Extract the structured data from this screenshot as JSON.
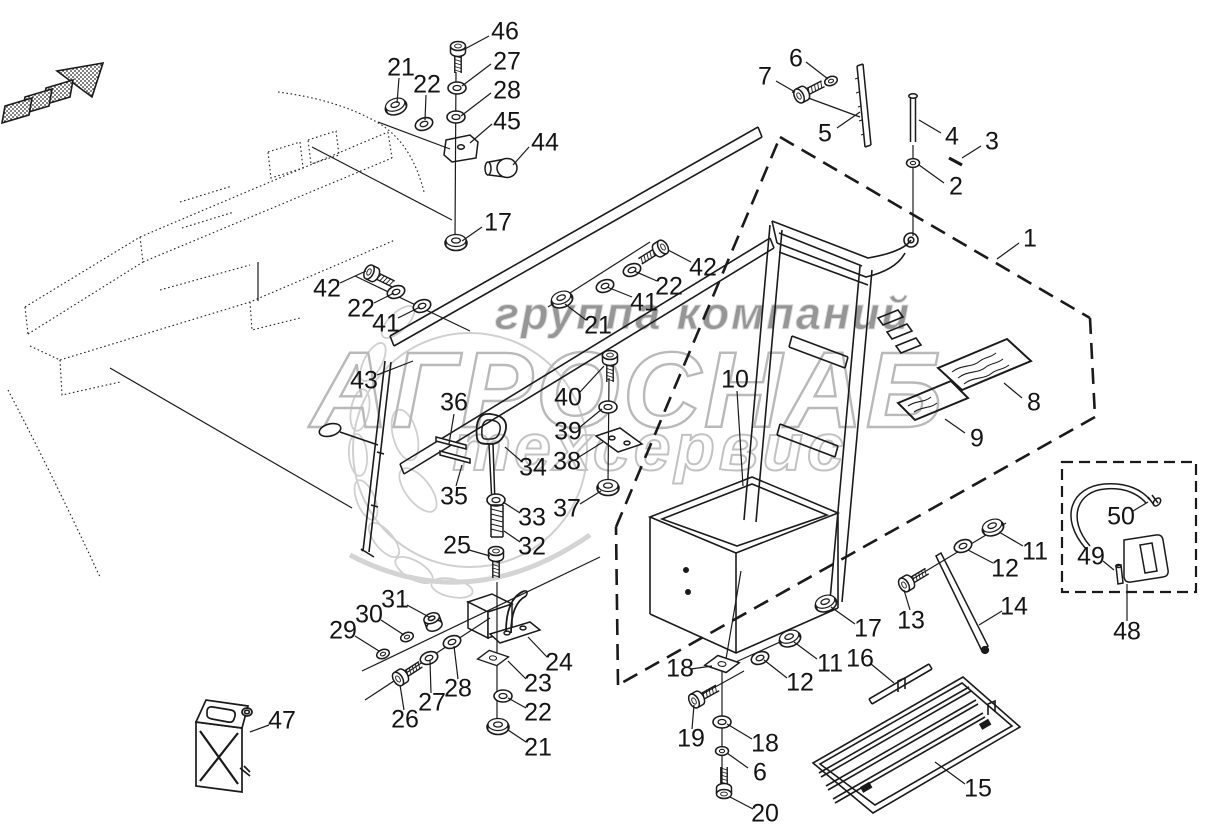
{
  "page": {
    "background": "#ffffff",
    "ink_color": "#1a1a1a",
    "type": "exploded-parts-diagram"
  },
  "watermark": {
    "line1": "группа компаний",
    "line2": "АГРОСНАБ",
    "line3": "техсервис",
    "color_dark": "#969696",
    "color_light": "#bdbdbd"
  },
  "icons": [
    {
      "name": "direction-arrow-icon",
      "meaning": "mounting direction indicator"
    }
  ],
  "diagram": {
    "labels": [
      {
        "part": "46",
        "x": 505,
        "y": 32
      },
      {
        "part": "27",
        "x": 507,
        "y": 62
      },
      {
        "part": "28",
        "x": 507,
        "y": 91
      },
      {
        "part": "45",
        "x": 507,
        "y": 122
      },
      {
        "part": "44",
        "x": 545,
        "y": 143
      },
      {
        "part": "21",
        "x": 401,
        "y": 68
      },
      {
        "part": "22",
        "x": 427,
        "y": 85
      },
      {
        "part": "17",
        "x": 498,
        "y": 223
      },
      {
        "part": "6",
        "x": 796,
        "y": 59
      },
      {
        "part": "7",
        "x": 765,
        "y": 77
      },
      {
        "part": "5",
        "x": 825,
        "y": 134
      },
      {
        "part": "4",
        "x": 952,
        "y": 137
      },
      {
        "part": "3",
        "x": 992,
        "y": 142
      },
      {
        "part": "2",
        "x": 956,
        "y": 187
      },
      {
        "part": "1",
        "x": 1030,
        "y": 239
      },
      {
        "part": "42",
        "x": 327,
        "y": 289
      },
      {
        "part": "22",
        "x": 361,
        "y": 309
      },
      {
        "part": "41",
        "x": 386,
        "y": 324
      },
      {
        "part": "43",
        "x": 364,
        "y": 381
      },
      {
        "part": "42",
        "x": 703,
        "y": 268
      },
      {
        "part": "22",
        "x": 669,
        "y": 287
      },
      {
        "part": "41",
        "x": 644,
        "y": 303
      },
      {
        "part": "21",
        "x": 598,
        "y": 326
      },
      {
        "part": "36",
        "x": 454,
        "y": 403
      },
      {
        "part": "40",
        "x": 568,
        "y": 398
      },
      {
        "part": "39",
        "x": 568,
        "y": 432
      },
      {
        "part": "38",
        "x": 567,
        "y": 462
      },
      {
        "part": "34",
        "x": 533,
        "y": 468
      },
      {
        "part": "35",
        "x": 454,
        "y": 497
      },
      {
        "part": "33",
        "x": 532,
        "y": 518
      },
      {
        "part": "37",
        "x": 567,
        "y": 509
      },
      {
        "part": "32",
        "x": 532,
        "y": 547
      },
      {
        "part": "25",
        "x": 457,
        "y": 546
      },
      {
        "part": "10",
        "x": 735,
        "y": 380
      },
      {
        "part": "8",
        "x": 1034,
        "y": 403
      },
      {
        "part": "9",
        "x": 977,
        "y": 439
      },
      {
        "part": "50",
        "x": 1121,
        "y": 517
      },
      {
        "part": "49",
        "x": 1091,
        "y": 557
      },
      {
        "part": "48",
        "x": 1127,
        "y": 632
      },
      {
        "part": "11",
        "x": 1035,
        "y": 552
      },
      {
        "part": "12",
        "x": 1005,
        "y": 569
      },
      {
        "part": "13",
        "x": 911,
        "y": 621
      },
      {
        "part": "14",
        "x": 1014,
        "y": 607
      },
      {
        "part": "31",
        "x": 395,
        "y": 600
      },
      {
        "part": "30",
        "x": 369,
        "y": 615
      },
      {
        "part": "29",
        "x": 343,
        "y": 631
      },
      {
        "part": "24",
        "x": 559,
        "y": 663
      },
      {
        "part": "23",
        "x": 538,
        "y": 684
      },
      {
        "part": "22",
        "x": 538,
        "y": 713
      },
      {
        "part": "21",
        "x": 538,
        "y": 748
      },
      {
        "part": "28",
        "x": 458,
        "y": 689
      },
      {
        "part": "27",
        "x": 432,
        "y": 703
      },
      {
        "part": "26",
        "x": 405,
        "y": 720
      },
      {
        "part": "47",
        "x": 282,
        "y": 721
      },
      {
        "part": "17",
        "x": 868,
        "y": 629
      },
      {
        "part": "16",
        "x": 860,
        "y": 659
      },
      {
        "part": "11",
        "x": 830,
        "y": 664
      },
      {
        "part": "12",
        "x": 800,
        "y": 683
      },
      {
        "part": "18",
        "x": 680,
        "y": 669
      },
      {
        "part": "19",
        "x": 691,
        "y": 739
      },
      {
        "part": "18",
        "x": 765,
        "y": 744
      },
      {
        "part": "6",
        "x": 760,
        "y": 773
      },
      {
        "part": "20",
        "x": 765,
        "y": 814
      },
      {
        "part": "15",
        "x": 978,
        "y": 789
      }
    ]
  }
}
